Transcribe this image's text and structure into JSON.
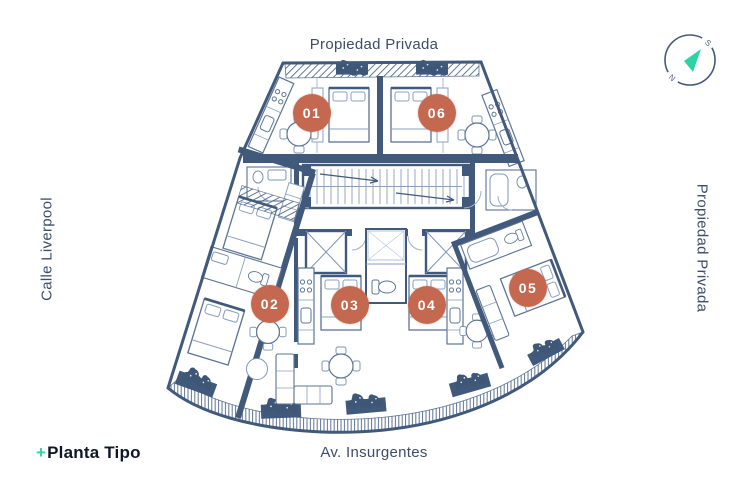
{
  "streets": {
    "top": "Propiedad Privada",
    "left": "Calle Liverpool",
    "right": "Propiedad Privada",
    "bottom": "Av. Insurgentes"
  },
  "logo": {
    "plus": "+",
    "name": "Planta Tipo"
  },
  "compass": {
    "letter_ne": "S",
    "letter_sw": "N"
  },
  "units": {
    "u01": "01",
    "u02": "02",
    "u03": "03",
    "u04": "04",
    "u05": "05",
    "u06": "06"
  },
  "colors": {
    "badge": "#c4684f",
    "accent": "#2dd3a5",
    "wall": "#41597b",
    "label": "#3d4d68"
  }
}
